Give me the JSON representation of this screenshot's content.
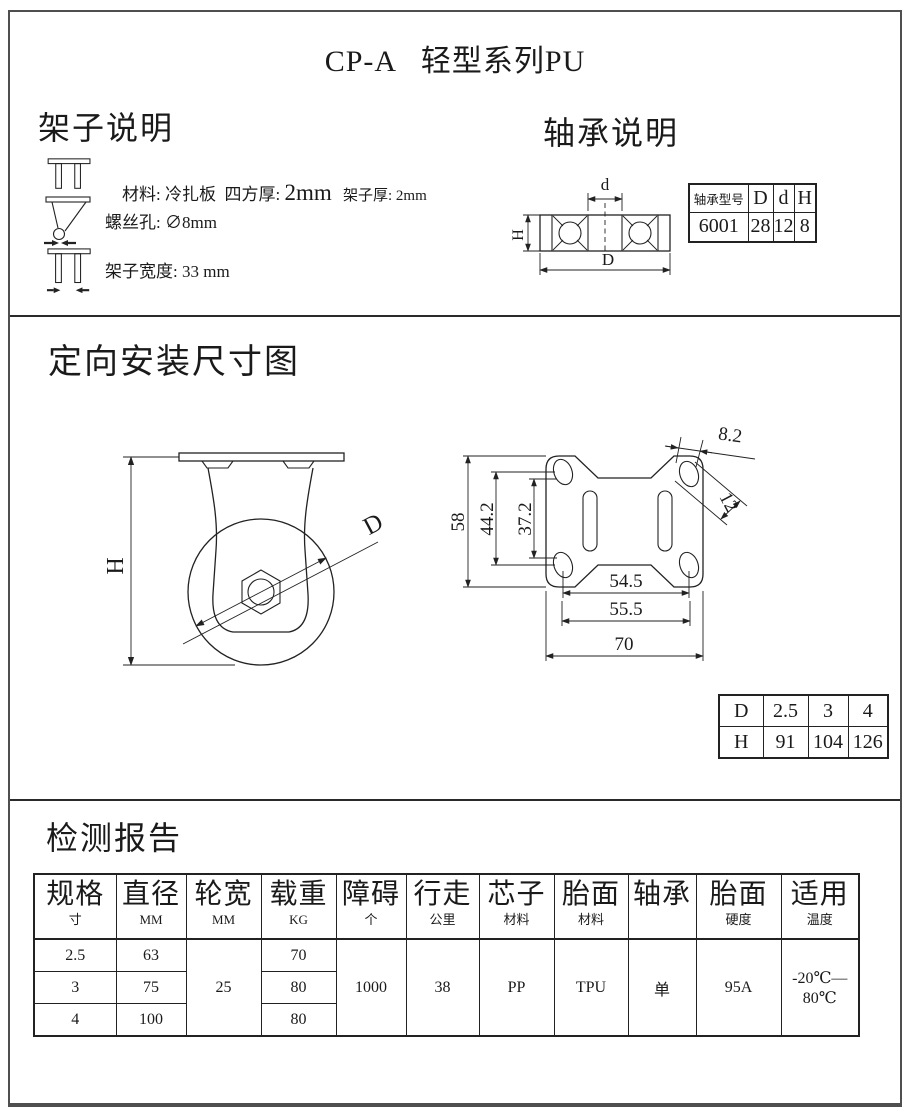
{
  "title": "CP-A   轻型系列PU",
  "frame": {
    "heading": "架子说明",
    "r1a": "材料: 冷扎板  四方厚: ",
    "r1b": "2mm",
    "r1c": "   架子厚: ",
    "r1d": "2mm",
    "r2": "螺丝孔: ∅8mm",
    "r3": "架子宽度: 33 mm"
  },
  "bearing": {
    "heading": "轴承说明",
    "diagram": {
      "d_label": "d",
      "h_label": "H",
      "D_label": "D"
    },
    "table": {
      "headers": [
        "轴承型号",
        "D",
        "d",
        "H"
      ],
      "values": [
        "6001",
        "28",
        "12",
        "8"
      ]
    }
  },
  "mounting": {
    "heading": "定向安装尺寸图",
    "side": {
      "h_label": "H",
      "d_label": "D"
    },
    "plate": {
      "outer": "58",
      "mid": "44.2",
      "inner": "37.2",
      "b1": "54.5",
      "b2": "55.5",
      "b3": "70",
      "hole_w": "8.2",
      "hole_l": "12"
    },
    "dh": {
      "r1": [
        "D",
        "2.5",
        "3",
        "4"
      ],
      "r2": [
        "H",
        "91",
        "104",
        "126"
      ]
    }
  },
  "report": {
    "heading": "检测报告",
    "columns": [
      {
        "t": "规格",
        "s": "寸"
      },
      {
        "t": "直径",
        "s": "MM"
      },
      {
        "t": "轮宽",
        "s": "MM"
      },
      {
        "t": "载重",
        "s": "KG"
      },
      {
        "t": "障碍",
        "s": "个"
      },
      {
        "t": "行走",
        "s": "公里"
      },
      {
        "t": "芯子",
        "s": "材料"
      },
      {
        "t": "胎面",
        "s": "材料"
      },
      {
        "t": "轴承",
        "s": ""
      },
      {
        "t": "胎面",
        "s": "硬度"
      },
      {
        "t": "适用",
        "s": "温度"
      }
    ],
    "spec": [
      "2.5",
      "3",
      "4"
    ],
    "diameter": [
      "63",
      "75",
      "100"
    ],
    "load": [
      "70",
      "80",
      "80"
    ],
    "wheel_width": "25",
    "obstacle": "1000",
    "distance": "38",
    "core": "PP",
    "tread": "TPU",
    "bearing": "单",
    "hardness": "95A",
    "temperature": "-20℃—80℃"
  }
}
